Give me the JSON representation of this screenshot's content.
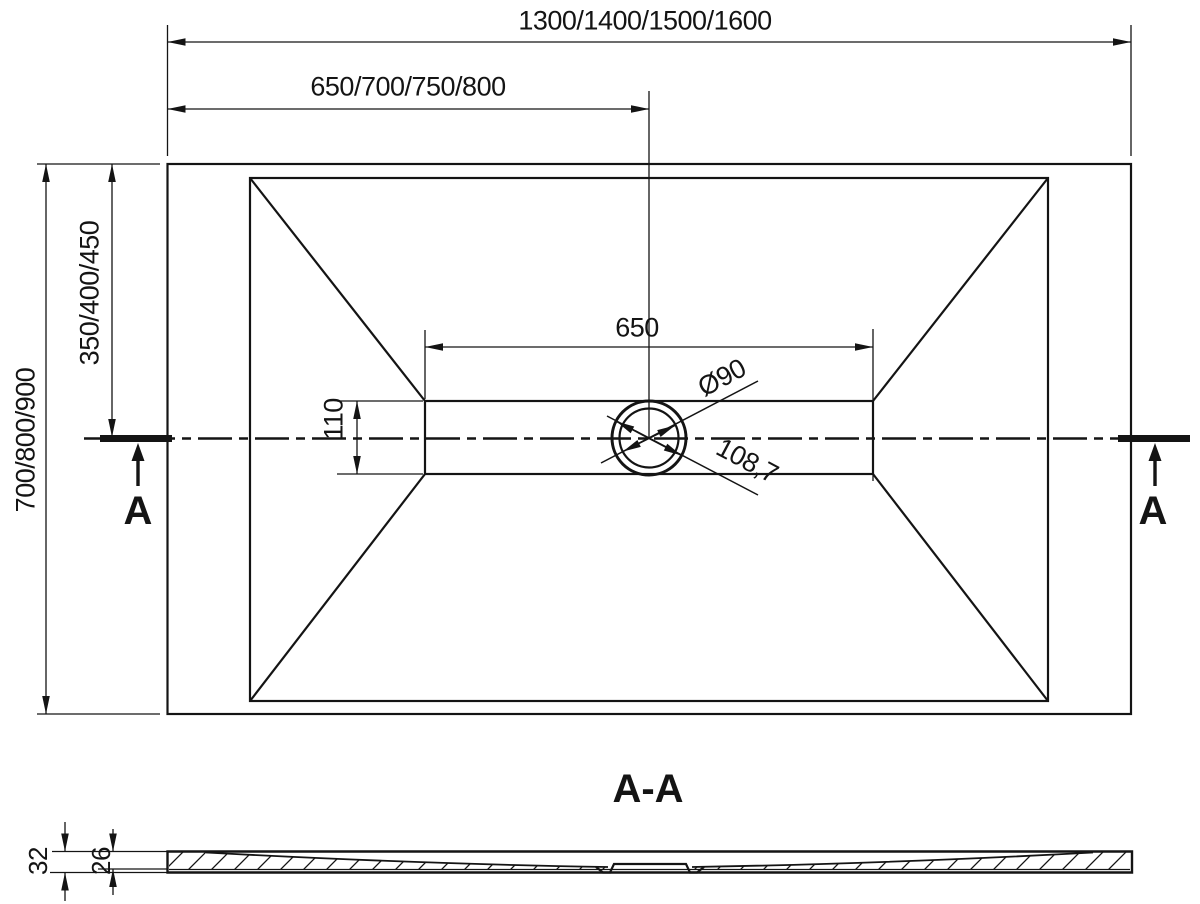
{
  "colors": {
    "ink": "#141414",
    "bg": "#ffffff"
  },
  "plan_view": {
    "dim_overall_length": "1300/1400/1500/1600",
    "dim_length_to_drain_center": "650/700/750/800",
    "dim_overall_width": "700/800/900",
    "dim_width_to_center": "350/400/450",
    "dim_channel_length": "650",
    "dim_channel_width": "110",
    "dim_drain_diameter": "Ø90",
    "dim_drain_flange_diameter": "108,7",
    "section_marker_left": "A",
    "section_marker_right": "A"
  },
  "section_view": {
    "label": "A-A",
    "dim_total_height": "32",
    "dim_inner_depth": "26"
  }
}
